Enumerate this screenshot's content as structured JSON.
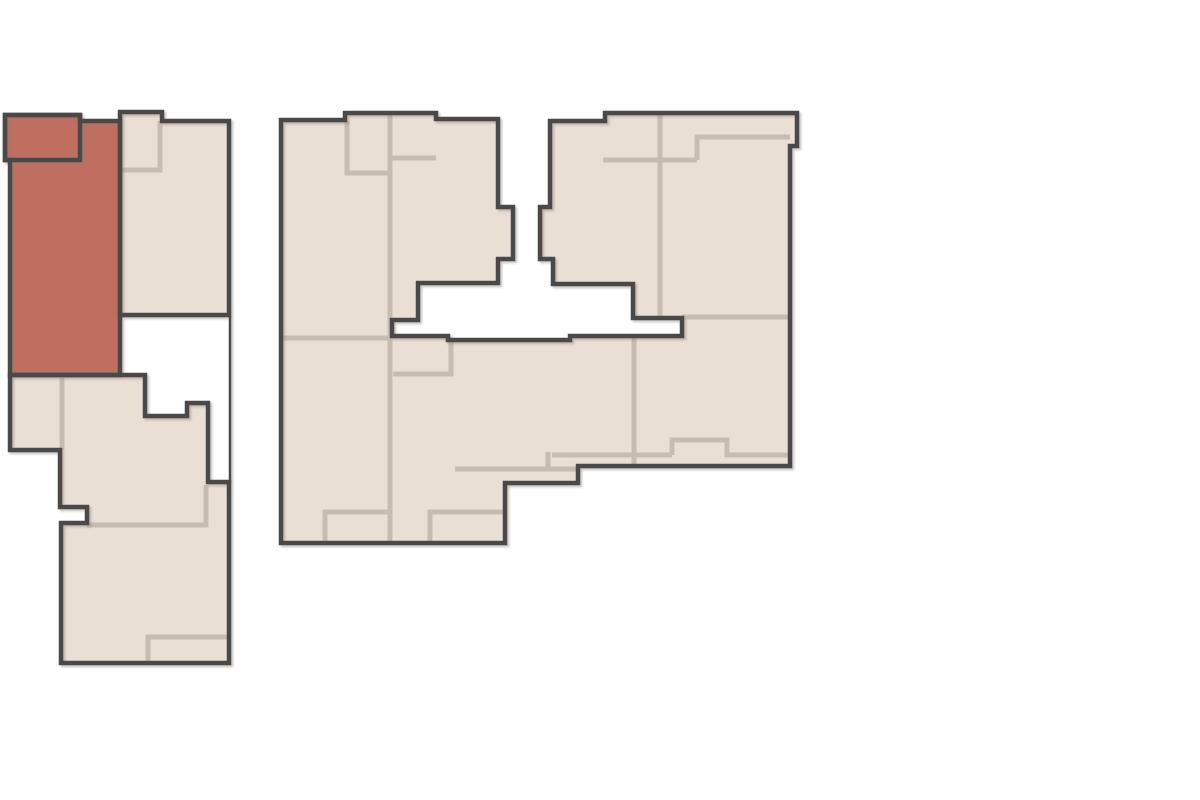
{
  "canvas": {
    "width": 1200,
    "height": 800,
    "background": "#ffffff"
  },
  "palette": {
    "unit_fill": "#eadfd4",
    "highlight_fill": "#bf6e60",
    "outline": "#4a4a4a",
    "inner_wall": "#c7bcb0",
    "shadow": "#8a8178",
    "outline_width": 4.5,
    "inner_width": 5,
    "thin_width": 2.5
  },
  "floorplan": {
    "units": [
      {
        "name": "building-main-floorplate",
        "fill": "unit_fill",
        "interactable": true,
        "points": "281,120 345,120 345,113 436,113 436,119 498,119 498,207 513,207 513,259 498,259 498,283 418,283 418,320 392,320 392,336 448,336 448,340 570,340 570,336 682,336 682,318 633,318 633,284 553,284 553,259 540,259 540,207 550,207 550,121 605,121 605,113 797,113 797,146 790,146 790,466 578,466 578,483 505,483 505,543 281,543"
      },
      {
        "name": "unit-lower-left-section",
        "fill": "unit_fill",
        "interactable": true,
        "points": "10,375 145,375 145,416 187,416 187,403 208,403 208,482 229,482 229,663 61,663 61,523 87,523 87,507 60,507 60,450 10,450"
      },
      {
        "name": "unit-top-right-of-left-block",
        "fill": "unit_fill",
        "interactable": true,
        "points": "120,112 162,112 162,121 229,121 229,315 120,315"
      },
      {
        "name": "unit-highlighted",
        "fill": "highlight_fill",
        "interactable": true,
        "points": "5,115 80,115 80,121 120,121 120,375 10,375 10,160 5,160"
      },
      {
        "name": "unit-highlighted-balcony",
        "fill": "highlight_fill",
        "interactable": false,
        "points": "5,115 80,115 80,160 5,160"
      }
    ],
    "inner_walls": [
      {
        "name": "inner-wall",
        "points": "121,170 160,170 160,121"
      },
      {
        "name": "inner-wall",
        "points": "62,378 62,450"
      },
      {
        "name": "inner-wall",
        "points": "87,525 206,525 206,485"
      },
      {
        "name": "inner-wall",
        "points": "148,663 148,637 228,637"
      },
      {
        "name": "inner-wall",
        "points": "347,121 347,173 390,173"
      },
      {
        "name": "inner-wall",
        "points": "390,114 390,543"
      },
      {
        "name": "inner-wall",
        "points": "390,158 436,158"
      },
      {
        "name": "inner-wall",
        "points": "283,338 390,338"
      },
      {
        "name": "inner-wall",
        "points": "325,543 325,512 390,512"
      },
      {
        "name": "inner-wall",
        "points": "430,543 430,512 503,512"
      },
      {
        "name": "inner-wall",
        "points": "451,339 451,374 393,374"
      },
      {
        "name": "inner-wall",
        "points": "455,469 577,469"
      },
      {
        "name": "inner-wall",
        "points": "548,452 548,469"
      },
      {
        "name": "inner-wall",
        "points": "660,114 660,318"
      },
      {
        "name": "inner-wall",
        "points": "603,160 697,160"
      },
      {
        "name": "inner-wall",
        "points": "697,160 697,137 790,137"
      },
      {
        "name": "inner-wall",
        "points": "682,317 790,317"
      },
      {
        "name": "inner-wall",
        "points": "634,336 634,466"
      },
      {
        "name": "inner-wall",
        "points": "552,455 672,455"
      },
      {
        "name": "inner-wall",
        "points": "672,455 672,440 727,440 727,455 790,455"
      }
    ],
    "thin_lines": [
      {
        "name": "corridor-edge-line",
        "points": "230,316 230,483"
      }
    ]
  }
}
